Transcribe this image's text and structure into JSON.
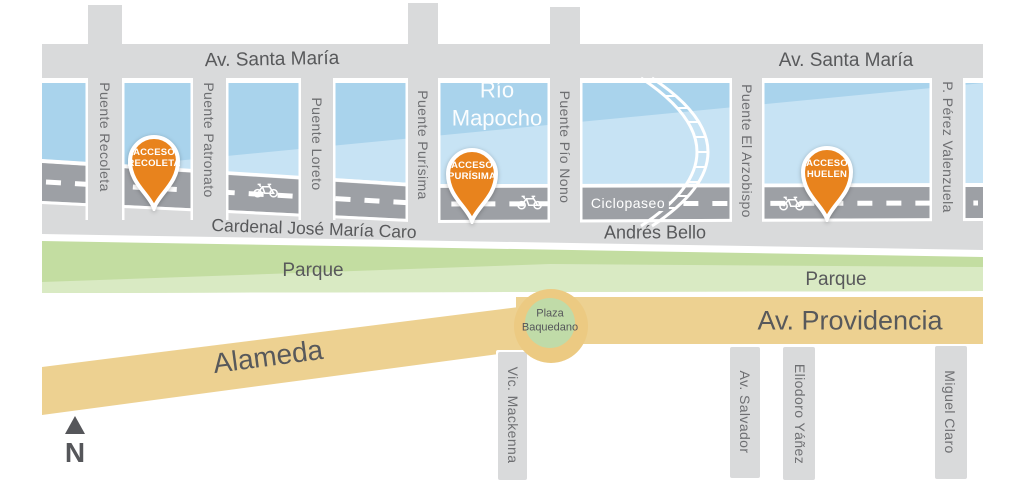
{
  "colors": {
    "accent_orange": "#e8831d",
    "river_blue": "#a9d3ec",
    "river_light": "#c7e3f4",
    "road_gray": "#9da0a5",
    "street_gray": "#d9dadb",
    "park_green": "#c3dda1",
    "park_light": "#dcebc6",
    "boulevard_yellow": "#edd191",
    "plaza_ring_yellow": "#ecca82",
    "plaza_green": "#c0dba8",
    "label_dark": "#58595b",
    "label_mid": "#6e6f72",
    "white": "#ffffff"
  },
  "top_street": {
    "label_left": "Av. Santa María",
    "label_right": "Av. Santa María"
  },
  "river": {
    "line1": "Río",
    "line2": "Mapocho"
  },
  "bridges": [
    {
      "label": "Puente Recoleta"
    },
    {
      "label": "Puente Patronato"
    },
    {
      "label": "Puente Loreto"
    },
    {
      "label": "Puente Purísima"
    },
    {
      "label": "Puente Pío Nono"
    },
    {
      "label": "Puente El Arzobispo"
    },
    {
      "label": "P. Pérez Valenzuela"
    }
  ],
  "access_points": [
    {
      "line1": "ACCESO",
      "line2": "RECOLETA"
    },
    {
      "line1": "ACCESO",
      "line2": "PURÍSIMA"
    },
    {
      "line1": "ACCESO",
      "line2": "HUELEN"
    }
  ],
  "bike_path": {
    "label": "Ciclopaseo"
  },
  "south_bank_streets": {
    "cardenal": "Cardenal José María Caro",
    "andres_bello": "Andrés Bello"
  },
  "parks": {
    "label_left": "Parque",
    "label_right": "Parque"
  },
  "boulevards": {
    "alameda": "Alameda",
    "providencia": "Av. Providencia"
  },
  "plaza": {
    "line1": "Plaza",
    "line2": "Baquedano"
  },
  "cross_streets": [
    {
      "label": "Vic. Mackenna"
    },
    {
      "label": "Av. Salvador"
    },
    {
      "label": "Eliodoro Yáñez"
    },
    {
      "label": "Miguel Claro"
    }
  ],
  "compass": {
    "label": "N"
  }
}
